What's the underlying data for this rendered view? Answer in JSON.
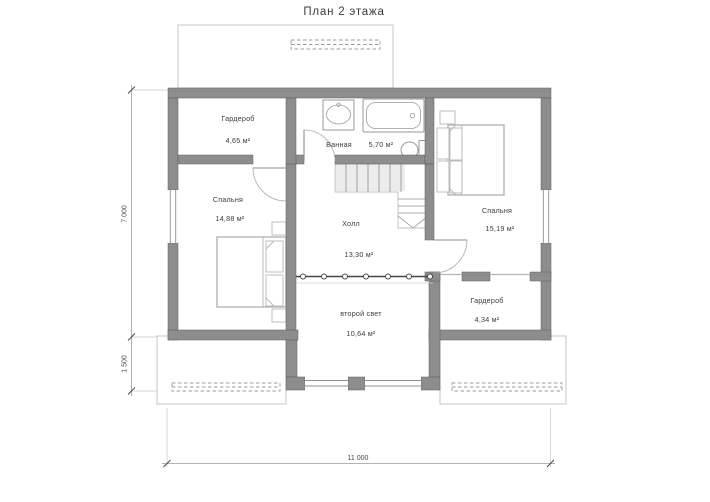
{
  "title": "План 2 этажа",
  "rooms": {
    "wardrobe_top": {
      "name": "Гардероб",
      "area": "4,65 м²"
    },
    "bathroom": {
      "name": "Ванная",
      "area": "5,70 м²"
    },
    "bedroom_left": {
      "name": "Спальня",
      "area": "14,88 м²"
    },
    "bedroom_right": {
      "name": "Спальня",
      "area": "15,19 м²"
    },
    "hall": {
      "name": "Холл",
      "area": "13,30 м²"
    },
    "second_light": {
      "name": "второй свет",
      "area": "10,64 м²"
    },
    "wardrobe_bottom": {
      "name": "Гардероб",
      "area": "4,34 м²"
    }
  },
  "dimensions": {
    "vertical_main": "7 000",
    "vertical_lower": "1 500",
    "horizontal_total": "11 000"
  },
  "colors": {
    "wall-fill": "#8d8d8d",
    "wall-stroke": "#5f5f5f",
    "furniture-stroke": "#b5b5b5",
    "fixture-stroke": "#9a9a9a",
    "text-color": "#3c3c3c",
    "dim-color": "#4a4a4a",
    "outline-light": "#c4c4c4"
  }
}
